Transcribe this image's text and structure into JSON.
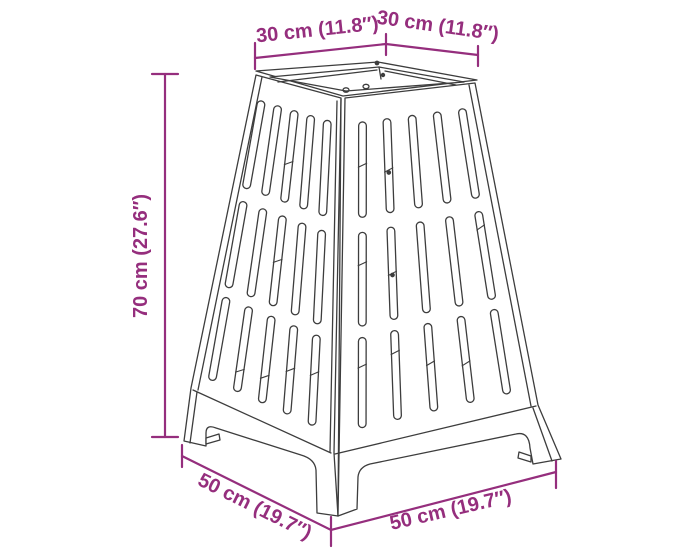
{
  "diagram": {
    "type": "product-dimension-drawing",
    "dimensions": {
      "top_left_width": "30 cm (11.8″)",
      "top_right_depth": "30 cm (11.8″)",
      "height": "70 cm (27.6″)",
      "bottom_left_depth": "50 cm (19.7″)",
      "bottom_right_width": "50 cm (19.7″)"
    },
    "colors": {
      "dimension_accent": "#952e7d",
      "drawing_line": "#3d3d3d",
      "background": "#ffffff"
    }
  }
}
